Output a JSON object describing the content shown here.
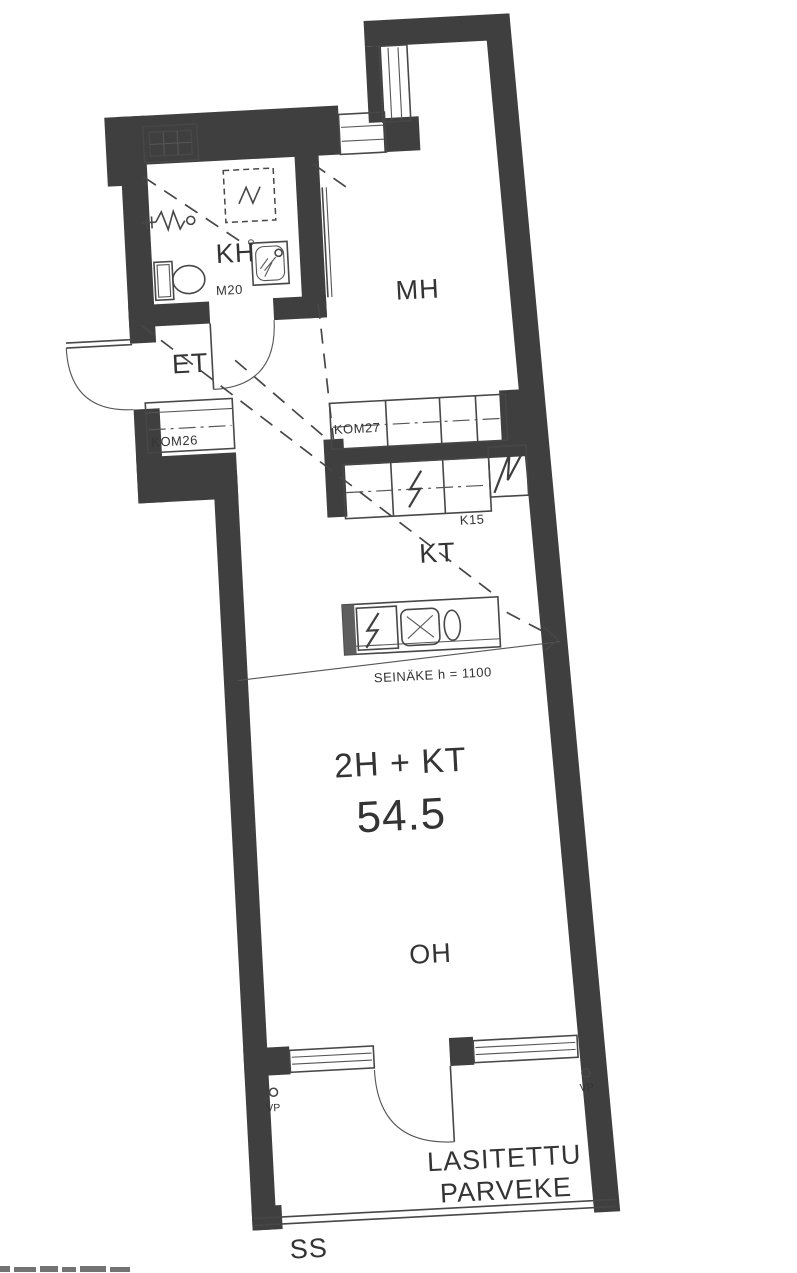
{
  "plan": {
    "layout_label": "2H + KT",
    "area_label": "54.5",
    "rooms": {
      "bathroom": "KH",
      "bedroom": "MH",
      "hallway": "ET",
      "kitchen": "KT",
      "living_room": "OH"
    },
    "balcony": {
      "name_line1": "LASITETTU",
      "name_line2": "PARVEKE",
      "ss": "SS",
      "vp_left": "VP",
      "vp_right": "VP"
    },
    "codes": {
      "door_m20": "M20",
      "closet_kom26": "KOM26",
      "closet_kom27": "KOM27",
      "fridge_k15": "K15",
      "partition": "SEINÄKE  h = 1100"
    },
    "symbols": [
      "toilet",
      "shower",
      "washing-machine-connection",
      "appliance-reservation",
      "vent-shaft",
      "stove",
      "refrigerator",
      "dishwasher",
      "sink",
      "sliding-door",
      "ceiling-slope-line",
      "entrance-door",
      "bathroom-door",
      "balcony-door",
      "window"
    ],
    "colors": {
      "wall": "#3f3f3f",
      "line": "#474747",
      "text": "#343434",
      "background": "#ffffff"
    }
  }
}
